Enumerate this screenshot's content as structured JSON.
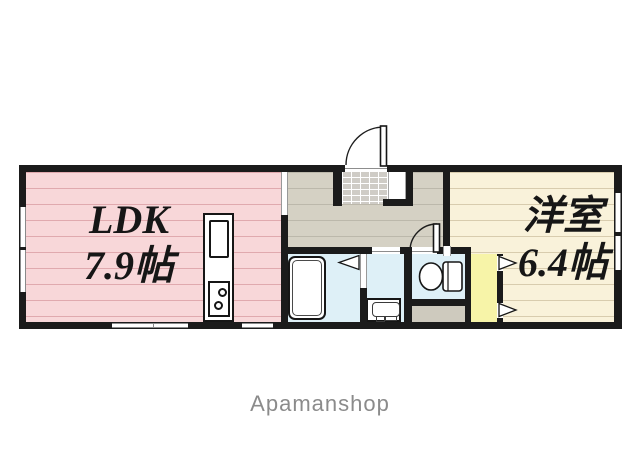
{
  "branding": {
    "watermark": "Apamanshop"
  },
  "rooms": {
    "ldk": {
      "name": "LDK",
      "size": "7.9帖",
      "floor_color": "#f8d7d9",
      "stripe_color": "#e0a9ae"
    },
    "western_room": {
      "name": "洋室",
      "size": "6.4帖",
      "floor_color": "#f9f2da",
      "stripe_color": "#d8ccae"
    },
    "hallway": {
      "floor_color": "#d5d1c4",
      "stripe_color": "#bcb8ab"
    },
    "entrance": {
      "tile_color": "#cfccc6"
    },
    "bathroom": {
      "floor_color": "#def0f7"
    },
    "washroom": {
      "floor_color": "#def0f7"
    },
    "toilet": {
      "floor_color": "#def0f7"
    },
    "closet": {
      "floor_color": "#f7f4a8"
    },
    "service_space": {
      "floor_color": "#cecabe"
    }
  },
  "palette": {
    "wall": "#1b1b1b",
    "background": "#ffffff",
    "fixture_outline": "#161616",
    "watermark_color": "#8b8b8b"
  },
  "fixtures": {
    "bathtub": "bathtub",
    "kitchen_counter": "kitchen-counter",
    "toilet": "toilet-fixture",
    "washbasin": "washbasin",
    "entrance_door": "entrance-swing-door",
    "toilet_door": "toilet-swing-door",
    "sliding_markers": "sliding-door-triangles"
  }
}
